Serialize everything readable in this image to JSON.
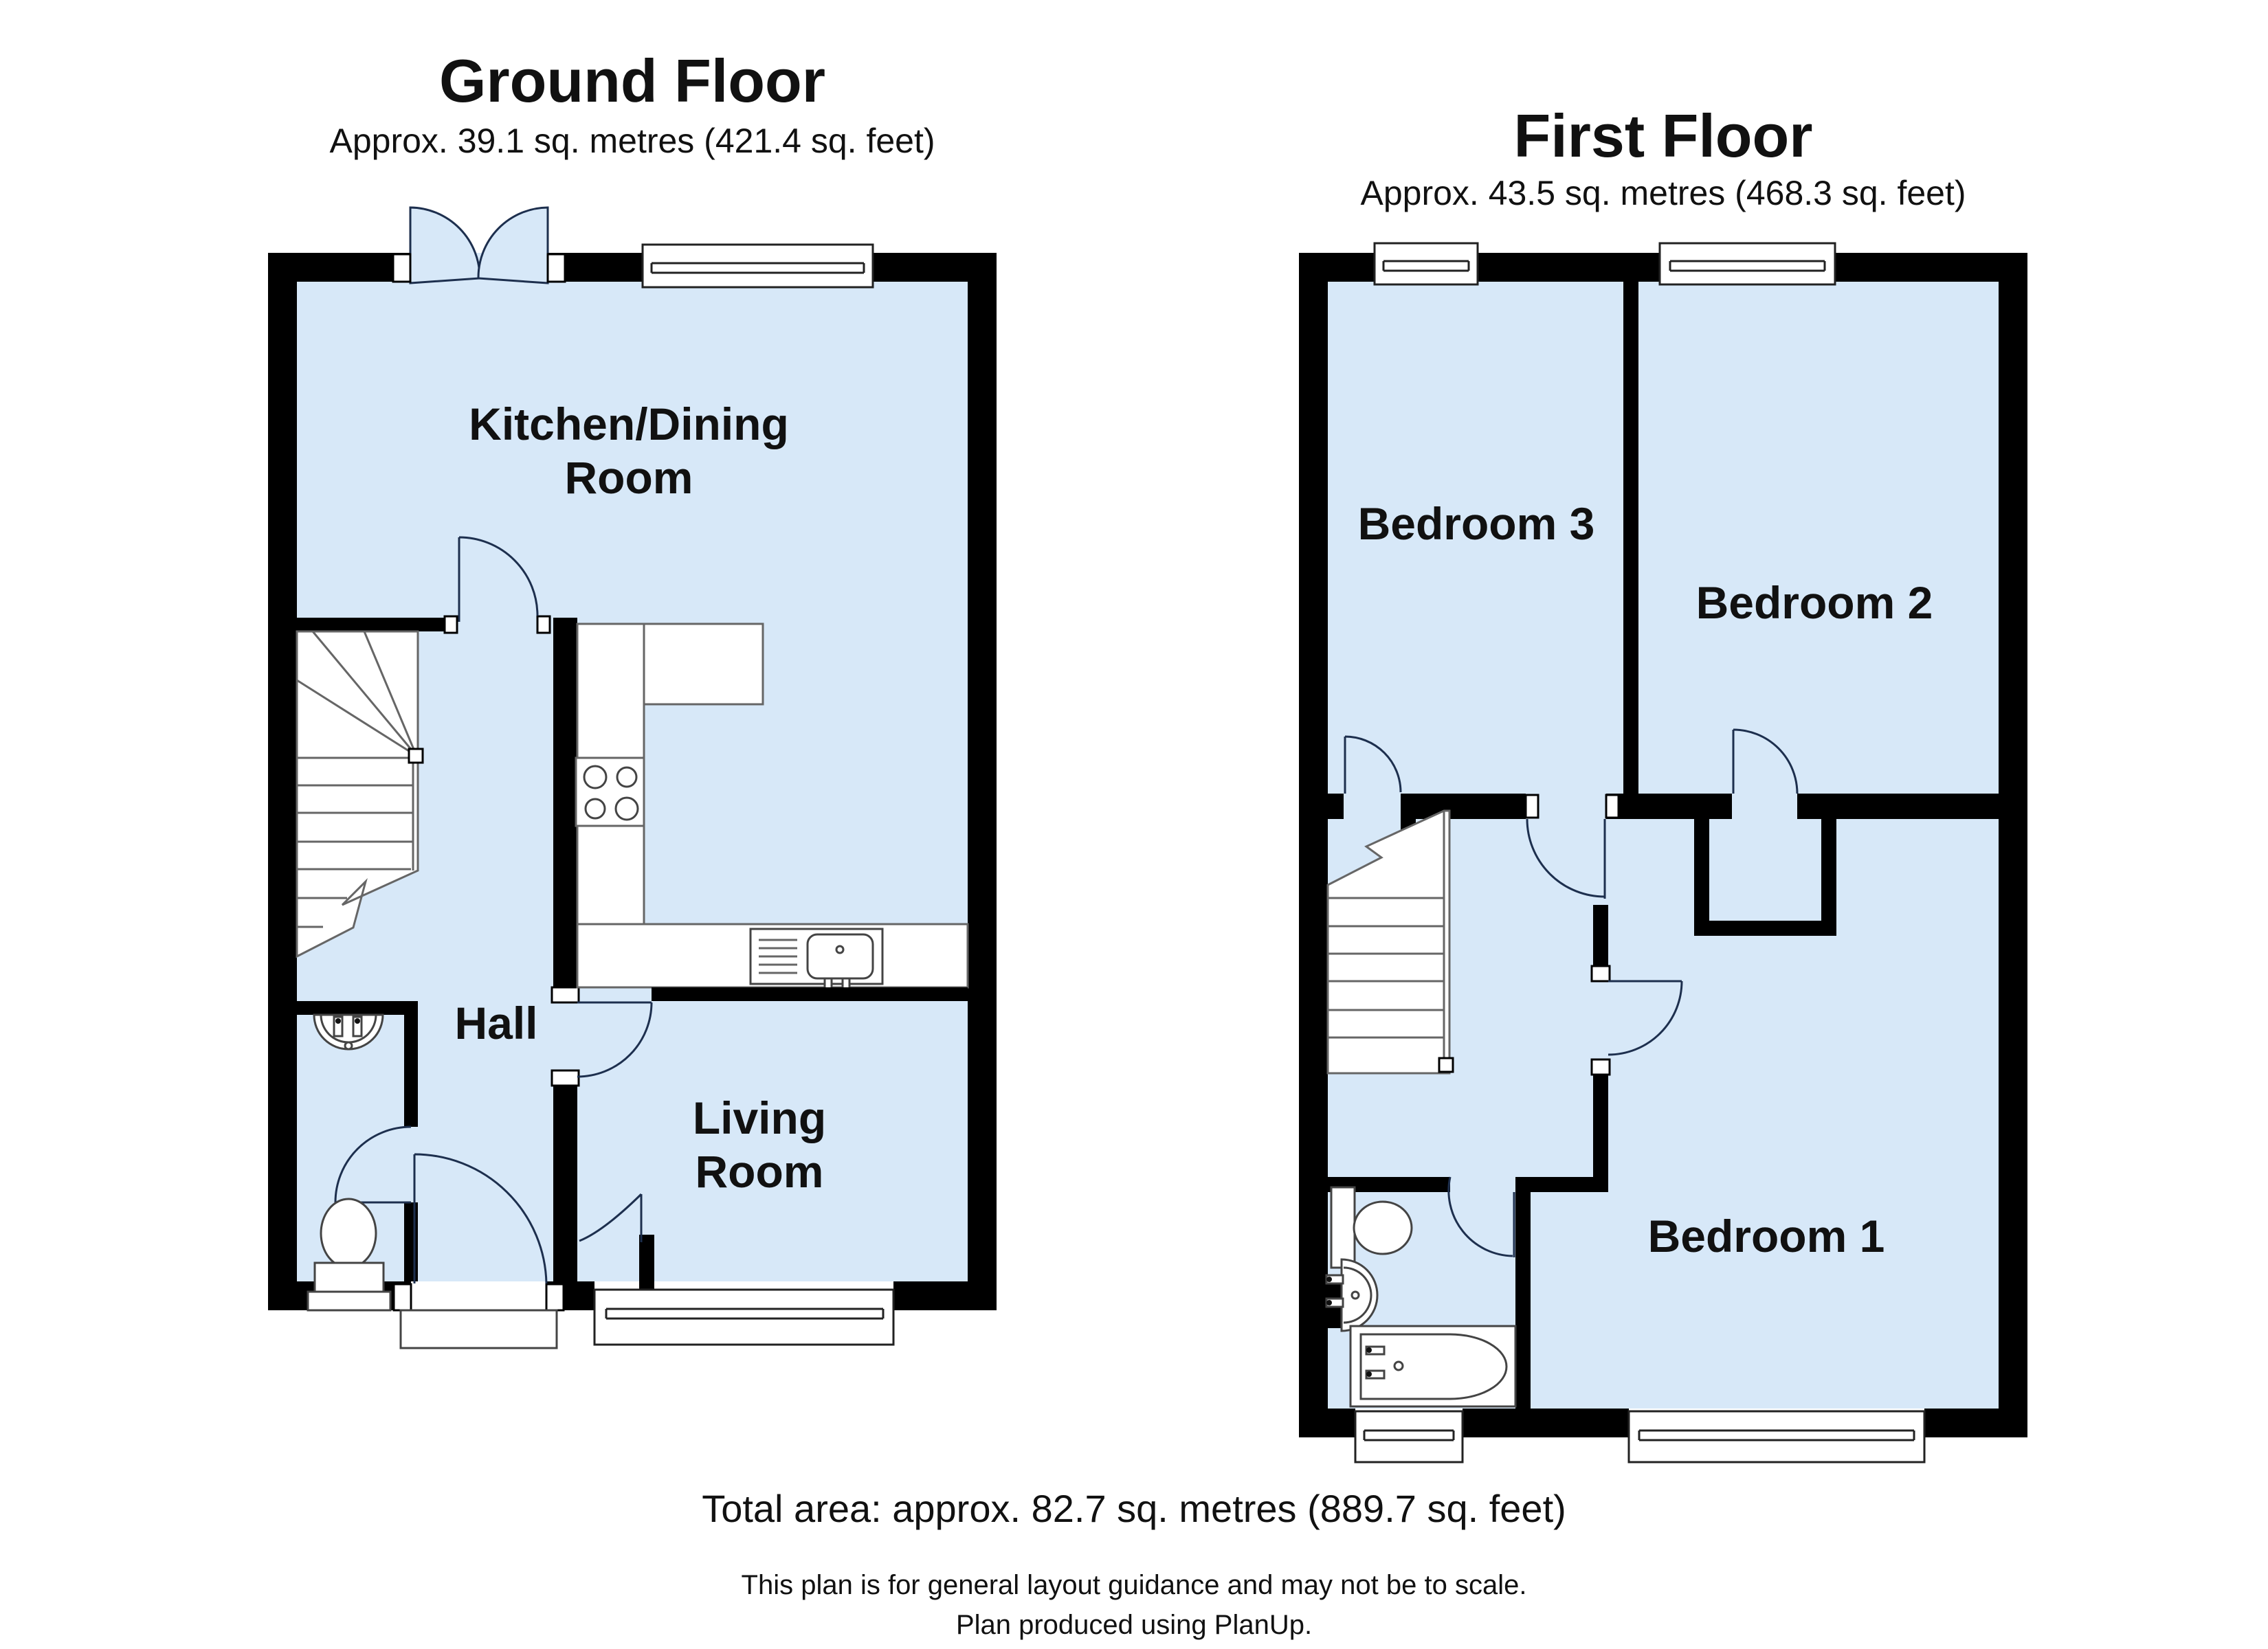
{
  "ground": {
    "title": "Ground Floor",
    "area": "Approx. 39.1 sq. metres (421.4 sq. feet)",
    "rooms": {
      "kitchen": {
        "line1": "Kitchen/Dining",
        "line2": "Room"
      },
      "hall": "Hall",
      "living": {
        "line1": "Living",
        "line2": "Room"
      }
    }
  },
  "first": {
    "title": "First Floor",
    "area": "Approx. 43.5 sq. metres (468.3 sq. feet)",
    "rooms": {
      "bed3": "Bedroom 3",
      "bed2": "Bedroom 2",
      "bed1": "Bedroom 1"
    }
  },
  "footer": {
    "total": "Total area: approx. 82.7 sq. metres (889.7 sq. feet)",
    "disclaimer": "This plan is for general layout guidance and may not be to scale.",
    "credit": "Plan produced using PlanUp."
  },
  "colors": {
    "floor": "#d7e8f8",
    "wall": "#000000"
  }
}
